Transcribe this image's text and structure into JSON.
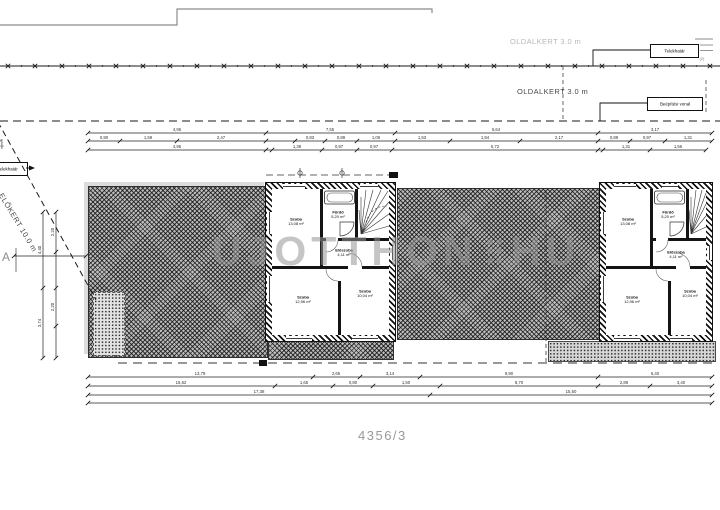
{
  "labels": {
    "side_yard_top": "OLDALKERT 3.0 m",
    "side_yard_mid": "OLDALKERT 3.0 m",
    "front_yard": "ELŐKERT 10.0 m",
    "boundary_right": "Telekhatár",
    "building_line": "Beépítési vonal",
    "boundary_left": "Telekhatár",
    "plot_number": "4356/3",
    "adjacent_plot": "4",
    "section_marker": "A",
    "edge_note": "(2)"
  },
  "watermark": {
    "name": "UJOTTHON",
    "tld": "HU"
  },
  "rooms": {
    "center": {
      "bedroom_top": {
        "name": "Szoba",
        "area": "13,08 m²"
      },
      "bathroom": {
        "name": "Fürdő",
        "area": "5,20 m²"
      },
      "hall": {
        "name": "Előszoba",
        "area": "4,11 m²"
      },
      "bedroom_left": {
        "name": "Szoba",
        "area": "12,96 m²"
      },
      "bedroom_right": {
        "name": "Szoba",
        "area": "10,04 m²"
      }
    },
    "right": {
      "bedroom_top": {
        "name": "Szoba",
        "area": "13,08 m²"
      },
      "bathroom": {
        "name": "Fürdő",
        "area": "5,20 m²"
      },
      "hall": {
        "name": "Előszoba",
        "area": "4,11 m²"
      },
      "bedroom_left": {
        "name": "Szoba",
        "area": "12,96 m²"
      },
      "bedroom_right": {
        "name": "Szoba",
        "area": "10,04 m²"
      }
    }
  },
  "dimensions": {
    "chains": [
      {
        "y": 133,
        "ticks": [
          88,
          266,
          395,
          598,
          712
        ],
        "labels": [
          [
            177,
            "4,95"
          ],
          [
            330,
            "7,55"
          ],
          [
            496,
            "5,64"
          ],
          [
            655,
            "3,17"
          ]
        ]
      },
      {
        "y": 141,
        "ticks": [
          88,
          120,
          177,
          266,
          295,
          325,
          357,
          395,
          450,
          520,
          598,
          630,
          665,
          712
        ],
        "labels": [
          [
            104,
            "0,90"
          ],
          [
            148,
            "1,58"
          ],
          [
            221,
            "2,47"
          ],
          [
            310,
            "0,83"
          ],
          [
            341,
            "0,89"
          ],
          [
            376,
            "1,06"
          ],
          [
            422,
            "1,53"
          ],
          [
            485,
            "1,94"
          ],
          [
            559,
            "2,17"
          ],
          [
            614,
            "0,89"
          ],
          [
            647,
            "0,97"
          ],
          [
            688,
            "1,31"
          ]
        ]
      },
      {
        "y": 150,
        "ticks": [
          88,
          266,
          272,
          322,
          357,
          392,
          598,
          603,
          650,
          706
        ],
        "labels": [
          [
            177,
            "4,95"
          ],
          [
            297,
            "1,39"
          ],
          [
            339,
            "0,97"
          ],
          [
            374,
            "0,97"
          ],
          [
            495,
            "5,72"
          ],
          [
            626,
            "1,31"
          ],
          [
            678,
            "1,56"
          ]
        ]
      },
      {
        "y": 256,
        "ticks": [
          14,
          86
        ],
        "labels": []
      },
      {
        "y": 377,
        "ticks": [
          88,
          313,
          360,
          420,
          598,
          712
        ],
        "labels": [
          [
            200,
            "13,79"
          ],
          [
            336,
            "2,65"
          ],
          [
            390,
            "3,14"
          ],
          [
            509,
            "9,90"
          ],
          [
            655,
            "6,40"
          ]
        ]
      },
      {
        "y": 386,
        "ticks": [
          88,
          275,
          333,
          373,
          440,
          598,
          650,
          712
        ],
        "labels": [
          [
            181,
            "15,62"
          ],
          [
            304,
            "1,65"
          ],
          [
            353,
            "0,80"
          ],
          [
            406,
            "1,50"
          ],
          [
            519,
            "8,70"
          ],
          [
            624,
            "2,89"
          ],
          [
            681,
            "3,40"
          ]
        ]
      },
      {
        "y": 395,
        "ticks": [
          88,
          430,
          712
        ],
        "labels": [
          [
            259,
            "17,38"
          ],
          [
            571,
            "15,50"
          ]
        ]
      },
      {
        "y": 403,
        "ticks": [
          88,
          712
        ],
        "labels": []
      }
    ],
    "vchains": [
      {
        "x": 43,
        "ticks": [
          212,
          288,
          358
        ],
        "labels": [
          [
            250,
            "4,40"
          ],
          [
            323,
            "3,74"
          ]
        ]
      },
      {
        "x": 56,
        "ticks": [
          212,
          252,
          288,
          326,
          358
        ],
        "labels": [
          [
            232,
            "2,20"
          ],
          [
            307,
            "2,20"
          ]
        ]
      }
    ]
  }
}
